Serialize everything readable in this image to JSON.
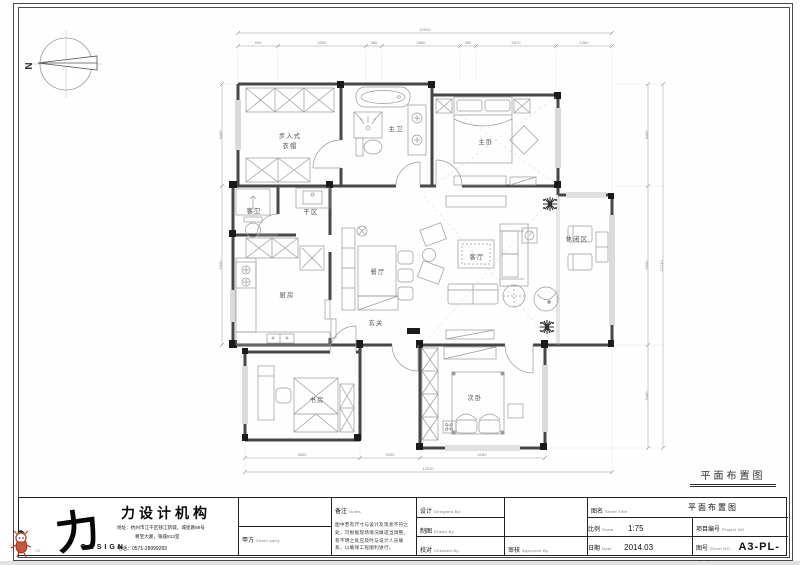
{
  "sheet": {
    "drawing_label": "平面布置图",
    "compass_n": "N"
  },
  "rooms": {
    "walkin_l1": "步入式",
    "walkin_l2": "衣帽",
    "master_bath": "主卫",
    "master_bedroom": "主卧",
    "guest_bath": "客卫",
    "dry_area": "干区",
    "kitchen": "厨房",
    "dining": "餐厅",
    "living": "客厅",
    "leisure": "休闲区",
    "foyer": "玄关",
    "study": "书房",
    "second_bedroom": "次卧"
  },
  "dims": {
    "top_total": "12020",
    "top": [
      "900",
      "3250",
      "380",
      "2880",
      "380",
      "2870",
      "1360"
    ],
    "right_total": "12140",
    "right": [
      "3400",
      "5300",
      "3440"
    ],
    "bottom_total": "12230",
    "bottom": [
      "3830",
      "2000",
      "4160"
    ],
    "left": [
      "3400",
      "5300"
    ]
  },
  "titleblock": {
    "logo_char": "力",
    "logo_sub": "DESIGN",
    "company_name": "力设计机构",
    "address1": "地址：杭州市江干区钱江新城，城星路89号",
    "address2": "尊宝大厦，银座813室",
    "phone": "电话：0571-28999293",
    "ce_mark": "CE",
    "client_label": "甲方",
    "client_en": "Client party",
    "notes_label": "备注",
    "notes_en": "Notes",
    "notes_text": "图中若有尺寸与设计及现状不符之处，可根据现场情况做适当调整，有不明之处应及时与设计人员联系，以确保工程顺利进行。",
    "designed_label": "设计",
    "designed_en": "Designed By:",
    "drawn_label": "制图",
    "drawn_en": "Drawn By:",
    "checked_label": "校对",
    "checked_en": "Checked By:",
    "approved_label": "审核",
    "approved_en": "Approved By:",
    "sheet_title_label": "图名",
    "sheet_title_en": "Sheet Title",
    "sheet_title_value": "平面布置图",
    "scale_label": "比例",
    "scale_en": "Scale",
    "scale_value": "1:75",
    "project_label": "项目编号",
    "project_en": "Project NO",
    "project_value": "",
    "date_label": "日期",
    "date_en": "Date",
    "date_value": "2014.03",
    "sheetno_label": "图号",
    "sheetno_en": "Sheet NO",
    "sheetno_value": "A3-PL-04"
  }
}
